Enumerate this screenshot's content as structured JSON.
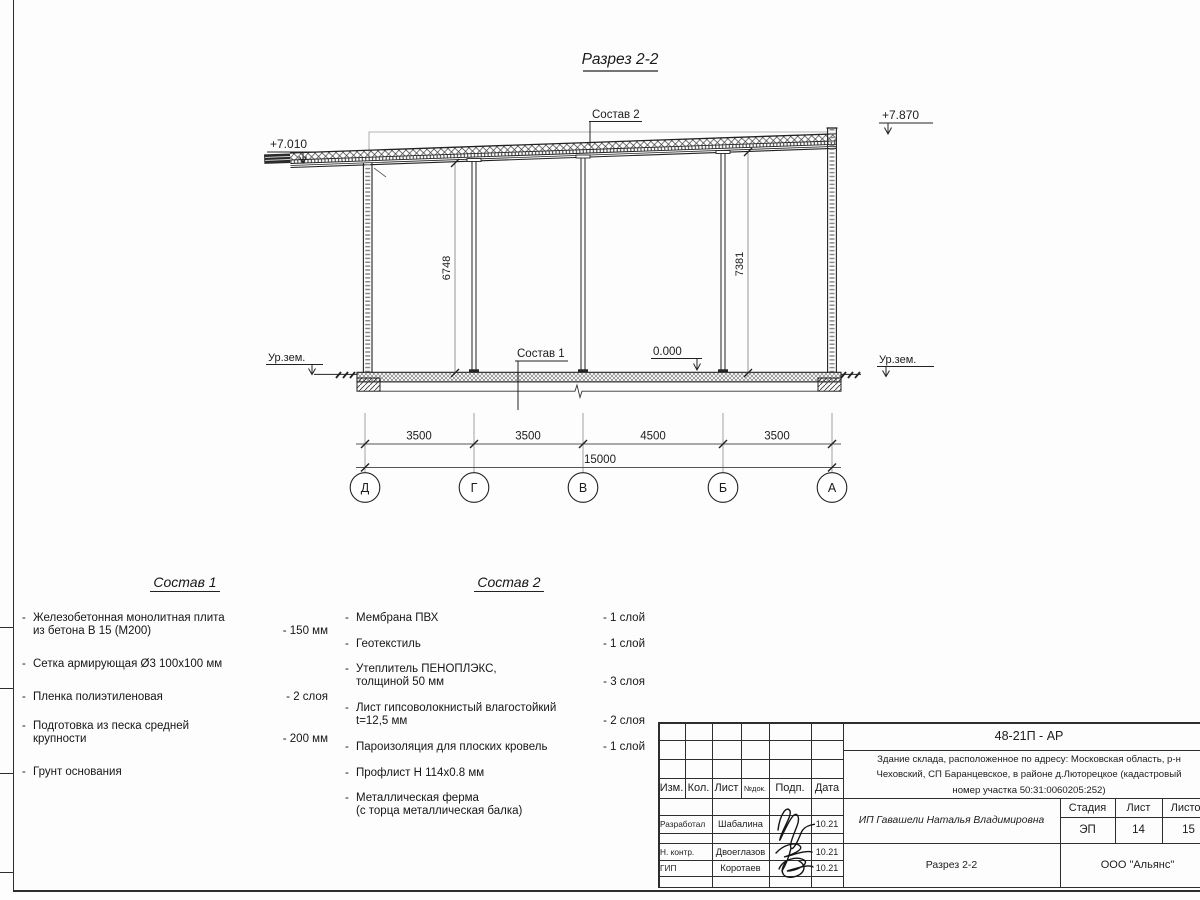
{
  "title": "Разрез 2-2",
  "section": {
    "elevation_left": "+7.010",
    "elevation_right": "+7.870",
    "roof_label": "Состав 2",
    "floor_label": "Состав 1",
    "level_zero": "0.000",
    "ground_left": "Ур.зем.",
    "ground_right": "Ур.зем.",
    "height_dim_left": "6748",
    "height_dim_right": "7381",
    "span_dims": [
      "3500",
      "3500",
      "4500",
      "3500"
    ],
    "total_dim": "15000",
    "axes": [
      "Д",
      "Г",
      "В",
      "Б",
      "А"
    ]
  },
  "sostav1": {
    "title": "Состав 1",
    "items": [
      {
        "text": "Железобетонная  монолитная плита\nиз бетона В 15 (М200)",
        "value": "- 150 мм"
      },
      {
        "text": "Сетка армирующая Ø3 100х100 мм",
        "value": ""
      },
      {
        "text": "Пленка полиэтиленовая",
        "value": "-  2 слоя"
      },
      {
        "text": "Подготовка из песка средней\nкрупности",
        "value": "- 200 мм"
      },
      {
        "text": "Грунт основания",
        "value": ""
      }
    ]
  },
  "sostav2": {
    "title": "Состав 2",
    "items": [
      {
        "text": "Мембрана ПВХ",
        "value": "- 1 слой"
      },
      {
        "text": "Геотекстиль",
        "value": "- 1 слой"
      },
      {
        "text": "Утеплитель ПЕНОПЛЭКС,\nтолщиной 50 мм",
        "value": "- 3 слоя"
      },
      {
        "text": "Лист гипсоволокнистый влагостойкий\nt=12,5 мм",
        "value": "- 2 слоя"
      },
      {
        "text": "Пароизоляция для плоских кровель",
        "value": "- 1 слой"
      },
      {
        "text": "Профлист Н 114х0.8 мм",
        "value": ""
      },
      {
        "text": "Металлическая ферма\n(с торца металлическая балка)",
        "value": ""
      }
    ]
  },
  "titleblock": {
    "doc_number": "48-21П - АР",
    "description_lines": [
      "Здание склада, расположенное по адресу: Московская область, р-н",
      "Чеховский, СП Баранцевское, в районе д.Люторецкое  (кадастровый",
      "номер участка 50:31:0060205:252)"
    ],
    "client": "ИП Гавашели Наталья Владимировна",
    "stage_label": "Стадия",
    "sheet_label": "Лист",
    "sheets_label": "Листов",
    "stage": "ЭП",
    "sheet": "14",
    "sheets": "15",
    "drawing_name": "Разрез 2-2",
    "company": "ООО \"Альянс\"",
    "header": [
      "Изм.",
      "Кол.",
      "Лист",
      "№док.",
      "Подп.",
      "Дата"
    ],
    "rows": [
      {
        "role": "Разработал",
        "name": "Шабалина",
        "date": "10.21"
      },
      {
        "role": "Н. контр.",
        "name": "Двоеглазов",
        "date": "10.21"
      },
      {
        "role": "ГИП",
        "name": "Коротаев",
        "date": "10.21"
      }
    ]
  }
}
